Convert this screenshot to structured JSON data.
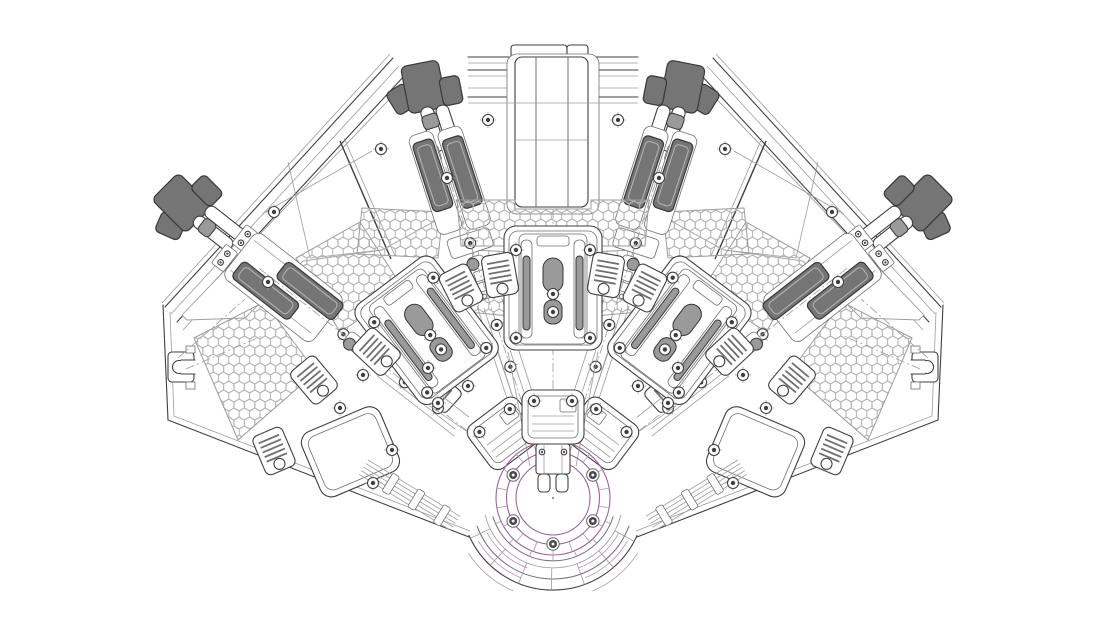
{
  "diagram": {
    "type": "engineering-cad-top-view",
    "content": "Fan-shaped radial machine assembly: five tool stations radiating from a bottom-center indexing hub, honeycomb mesh panels, linear slide rails with dark slider blocks, dark corner clamp fixtures, cover plates and chain guides",
    "visible_text": "none"
  },
  "colors": {
    "background": "#ffffff",
    "line_dark": "#3f3f3f",
    "line_mid": "#6f6f6f",
    "line_light": "#9c9c9c",
    "hex_line": "#b2b2b2",
    "fill_dark": "#757575",
    "fill_dark_border": "#383838",
    "fill_mid": "#9a9a9a",
    "purple": "#9a639b",
    "purple_light": "#b895b8"
  },
  "geometry": {
    "station_angles_deg": [
      -52,
      -37,
      -18,
      0,
      18,
      37,
      52
    ],
    "hub": {
      "center": [
        553,
        498
      ],
      "purple_ring_radii": [
        37,
        46.5,
        57
      ],
      "purple_spoke_radii": [
        46.5,
        57
      ],
      "purple_spoke_step_deg": 20,
      "purple_spoke_start": 10,
      "inner_spoke_radii": [
        57,
        63
      ],
      "inner_spoke_angles": [
        204,
        226,
        248,
        270,
        292,
        314,
        336
      ],
      "outer_spoke_radii": [
        70,
        92
      ],
      "outer_spoke_angles": [
        206,
        227,
        248,
        269,
        290,
        311,
        332
      ],
      "bolt_radius": 46,
      "bolt_angles": [
        30,
        90,
        150,
        210,
        270,
        330
      ]
    }
  }
}
